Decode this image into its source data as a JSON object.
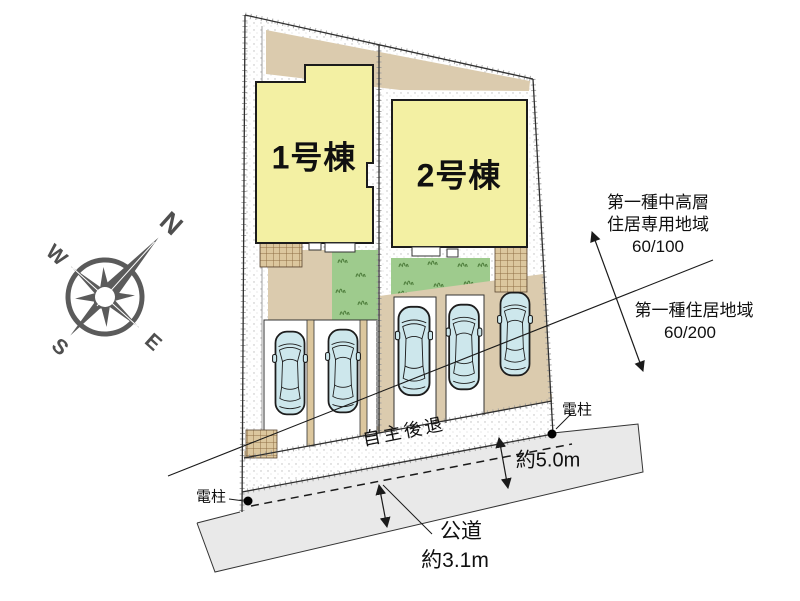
{
  "site_plan": {
    "buildings": [
      {
        "label": "1号棟"
      },
      {
        "label": "2号棟"
      }
    ],
    "parking": {
      "car_count": 5
    },
    "setback_label": "自主後退",
    "utility_pole_left": "電柱",
    "utility_pole_right": "電柱",
    "road": {
      "label": "公道",
      "width_front": "約3.1m",
      "width_side": "約5.0m"
    },
    "zoning_upper": {
      "line1": "第一種中高層",
      "line2": "住居専用地域",
      "ratio": "60/100"
    },
    "zoning_lower": {
      "line1": "第一種住居地域",
      "ratio": "60/200"
    },
    "compass": {
      "n": "N",
      "e": "E",
      "s": "S",
      "w": "W"
    },
    "colors": {
      "building_fill": "#f3f0a3",
      "grass": "#9ecb8d",
      "car": "#cde7ec",
      "road": "#e9e9e9",
      "tan": "#dbcbae",
      "terrace": "#dcc79e",
      "line": "#1a1a1a",
      "compass": "#5b5b5b"
    }
  }
}
